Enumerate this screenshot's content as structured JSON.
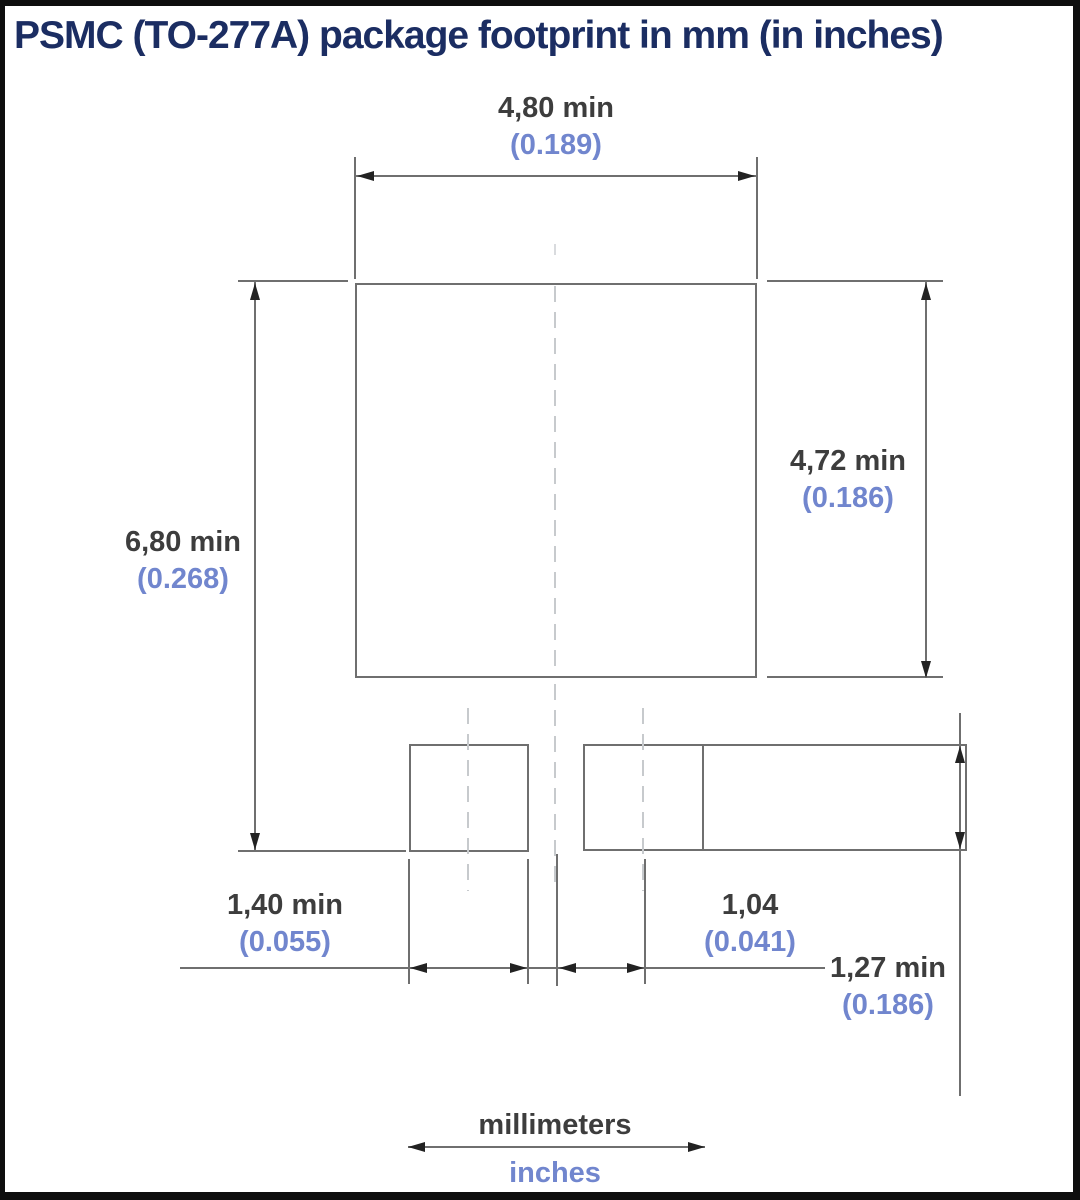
{
  "title": "PSMC (TO-277A) package footprint in mm (in inches)",
  "dimensions": {
    "top_width": {
      "mm": "4,80 min",
      "inch": "(0.189)"
    },
    "left_height": {
      "mm": "6,80 min",
      "inch": "(0.268)"
    },
    "right_height": {
      "mm": "4,72 min",
      "inch": "(0.186)"
    },
    "small_pad_width": {
      "mm": "1,40 min",
      "inch": "(0.055)"
    },
    "center_offset": {
      "mm": "1,04",
      "inch": "(0.041)"
    },
    "terminal_height": {
      "mm": "1,27 min",
      "inch": "(0.186)"
    }
  },
  "legend": {
    "millimeters": "millimeters",
    "inches": "inches"
  },
  "colors": {
    "title_text": "#1b2d62",
    "mm_text": "#3d3d3d",
    "inch_text": "#7186ce",
    "drawing_line": "#6f6f6f",
    "arrow": "#222222",
    "frame_border": "#0e0e0e"
  }
}
